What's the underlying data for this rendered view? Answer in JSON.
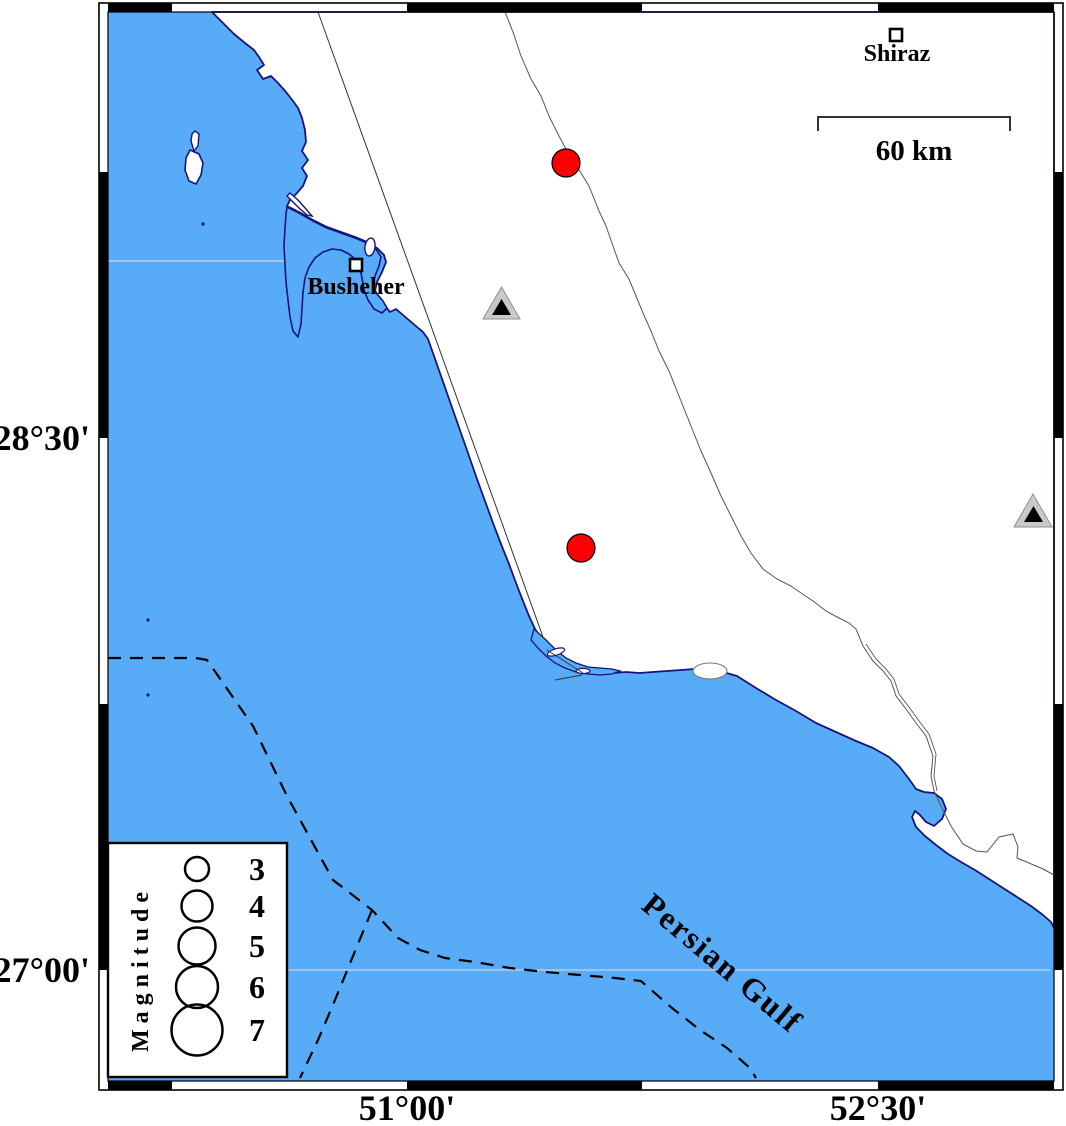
{
  "map": {
    "title": "Busheher region seismicity map",
    "axis": {
      "left_labels": [
        "28°30'",
        "27°00'"
      ],
      "bottom_labels": [
        "51°00'",
        "52°30'"
      ]
    },
    "sea_label": "Persian Gulf",
    "scale_bar": {
      "label": "60 km"
    },
    "cities": [
      {
        "name": "Shiraz",
        "x": 896,
        "y": 35
      },
      {
        "name": "Busheher",
        "x": 356,
        "y": 265
      }
    ],
    "earthquakes": [
      {
        "x": 566,
        "y": 163,
        "radius": 14
      },
      {
        "x": 581,
        "y": 548,
        "radius": 14
      }
    ],
    "stations": [
      {
        "x": 501,
        "y": 305
      },
      {
        "x": 1033,
        "y": 512
      }
    ],
    "legend": {
      "title": "Magnitude",
      "magnitudes": [
        "3",
        "4",
        "5",
        "6",
        "7"
      ]
    },
    "colors": {
      "sea": "#57abf7",
      "land": "#ffffff",
      "coastline": "#14147a",
      "earthquake": "#fa0000",
      "station_fill": "#c9c9c9",
      "station_inner": "#000000",
      "frame": "#000000"
    }
  }
}
